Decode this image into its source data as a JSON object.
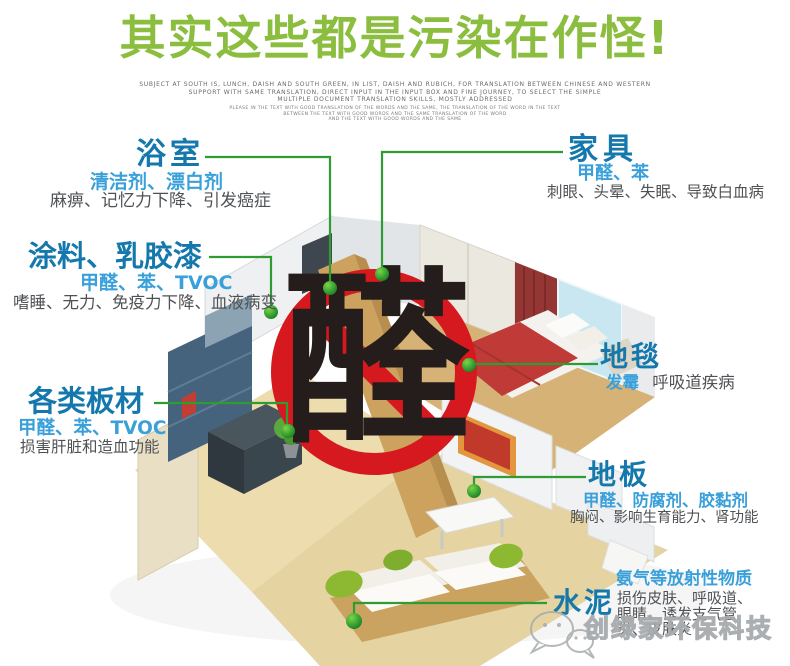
{
  "page": {
    "title": "其实这些都是污染在作怪!"
  },
  "fineprint": [
    "SUBJECT AT SOUTH IS, LUNCH, DAISH AND SOUTH GREEN, IN LIST, DAISH AND RUBICH, FOR TRANSLATION BETWEEN CHINESE AND WESTERN",
    "SUPPORT WITH SAME TRANSLATION, DIRECT INPUT IN THE INPUT BOX AND FINE JOURNEY, TO SELECT THE SIMPLE",
    "MULTIPLE DOCUMENT TRANSLATION SKILLS, MOSTLY ADDRESSED",
    "PLEASE IN THE TEXT WITH GOOD TRANSLATION OF THE WORDS AND THE SAME, THE TRANSLATION OF THE WORD IN THE TEXT",
    "BETWEEN THE TEXT WITH GOOD WORDS AND THE SAME TRANSLATION OF THE WORD",
    "AND THE TEXT WITH GOOD WORDS AND THE SAME"
  ],
  "center": {
    "character": "醛"
  },
  "sections": {
    "bathroom": {
      "title": "浴室",
      "pollutants": "清洁剂、漂白剂",
      "effects": "麻痹、记忆力下降、引发癌症"
    },
    "paint": {
      "title": "涂料、乳胶漆",
      "pollutants": "甲醛、苯、TVOC",
      "effects": "嗜睡、无力、免疫力下降、血液病变"
    },
    "boards": {
      "title": "各类板材",
      "pollutants": "甲醛、苯、TVOC",
      "effects": "损害肝脏和造血功能"
    },
    "furniture": {
      "title": "家具",
      "pollutants": "甲醛、苯",
      "effects": "刺眼、头晕、失眠、导致白血病"
    },
    "carpet": {
      "title": "地毯",
      "pollutants": "发霉",
      "effects": "呼吸道疾病"
    },
    "floor": {
      "title": "地板",
      "pollutants": "甲醛、防腐剂、胶黏剂",
      "effects": "胸闷、影响生育能力、肾功能"
    },
    "cement": {
      "title": "水泥",
      "pollutants": "氨气等放射性物质",
      "effects_lines": [
        "损伤皮肤、呼吸道、",
        "眼睛、诱发支气管",
        "炎、皮肤炎"
      ]
    }
  },
  "watermark": {
    "brand": "创绿家环保科技"
  },
  "colors": {
    "title_green": "#8bbd3e",
    "label_blue": "#1478ac",
    "sub_blue": "#3aa0da",
    "text_gray": "#4f5255",
    "line_green": "#2f9b33",
    "sign_red": "#d6181f",
    "character_black": "#241d1b"
  }
}
